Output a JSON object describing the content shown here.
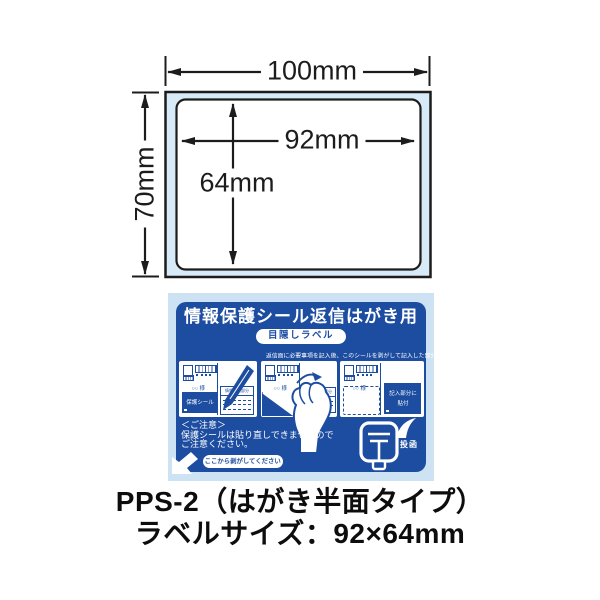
{
  "colors": {
    "dark_blue": "#1c4da0",
    "light_blue": "#cde3f3",
    "diagram_fill": "#d7eaf8",
    "line_black": "#1c1c1c",
    "text_black": "#0d0d0d"
  },
  "diagram": {
    "sheet_width": "100mm",
    "sheet_height": "70mm",
    "label_width": "92mm",
    "label_height": "64mm"
  },
  "card": {
    "title": "情報保護シール返信はがき用",
    "badge": "目隠しラベル",
    "instruction": "返信面に必要事項を記入後、このシールを剥がして記入した部分に貼付してください。",
    "seal_label": "保護シール",
    "form_label": "情報記入部分",
    "paste_label_line1": "記入部分に",
    "paste_label_line2": "貼付",
    "addressee": "○○ 様",
    "notice_title": "＜ご注意＞",
    "notice_line1": "保護シールは貼り直しできませんので",
    "notice_line2": "ご注意ください。",
    "peel_pill": "ここから剥がしてください",
    "post_label": "投函"
  },
  "caption": {
    "line1": "PPS-2（はがき半面タイプ）",
    "line2": "ラベルサイズ：92×64mm"
  }
}
